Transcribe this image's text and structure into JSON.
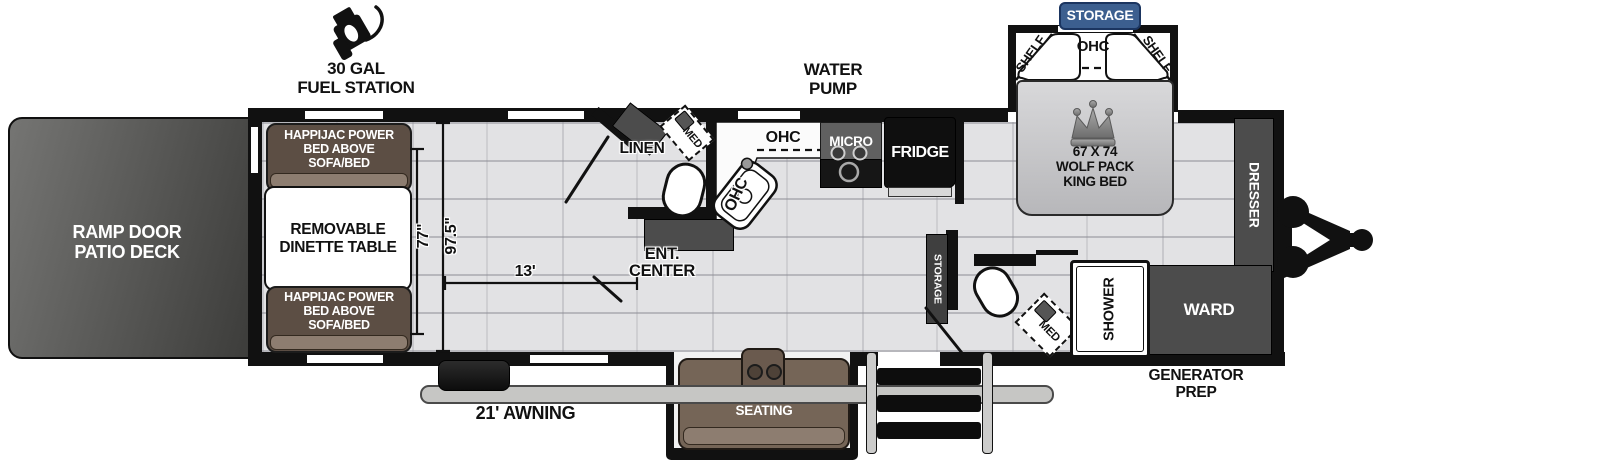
{
  "exterior": {
    "storage_badge": "STORAGE",
    "fuel": {
      "lines": [
        "30 GAL",
        "FUEL STATION"
      ]
    },
    "water_pump": {
      "lines": [
        "WATER",
        "PUMP"
      ]
    },
    "awning": "21' AWNING",
    "generator": {
      "lines": [
        "GENERATOR",
        "PREP"
      ]
    },
    "ramp": {
      "lines": [
        "RAMP DOOR",
        "PATIO DECK"
      ]
    }
  },
  "garage": {
    "sofa": {
      "lines": [
        "HAPPIJAC POWER",
        "BED ABOVE",
        "SOFA/BED"
      ]
    },
    "dinette": {
      "lines": [
        "REMOVABLE",
        "DINETTE TABLE"
      ]
    },
    "dims": {
      "sofa_length": "77\"",
      "interior_width": "97.5\"",
      "garage_length": "13'"
    }
  },
  "bath1": {
    "linen": "LINEN",
    "med": "MED",
    "ent": {
      "lines": [
        "ENT.",
        "CENTER"
      ]
    }
  },
  "kitchen": {
    "ohc": "OHC",
    "ohc_counter": "OHC",
    "micro": "MICRO",
    "fridge": "FRIDGE"
  },
  "bedroom": {
    "shelf": "SHELF",
    "ohc": "OHC",
    "bed": {
      "lines": [
        "67 X 74",
        "WOLF PACK",
        "KING BED"
      ]
    },
    "dresser": "DRESSER",
    "ward": "WARD"
  },
  "bath2": {
    "storage": "STORAGE",
    "med": "MED",
    "shower": "SHOWER"
  },
  "living": {
    "theater": {
      "lines": [
        "THEATER",
        "SEATING"
      ]
    }
  },
  "colors": {
    "wall": "#111111",
    "floor": "#e2e2e4",
    "cabinet": "#4c4c4c",
    "sofa": "#6f6056",
    "sofa_light": "#8d7d70",
    "badge_blue": "#3c5f8f",
    "appliance": "#141414",
    "ramp_door": "#5a5a58"
  }
}
